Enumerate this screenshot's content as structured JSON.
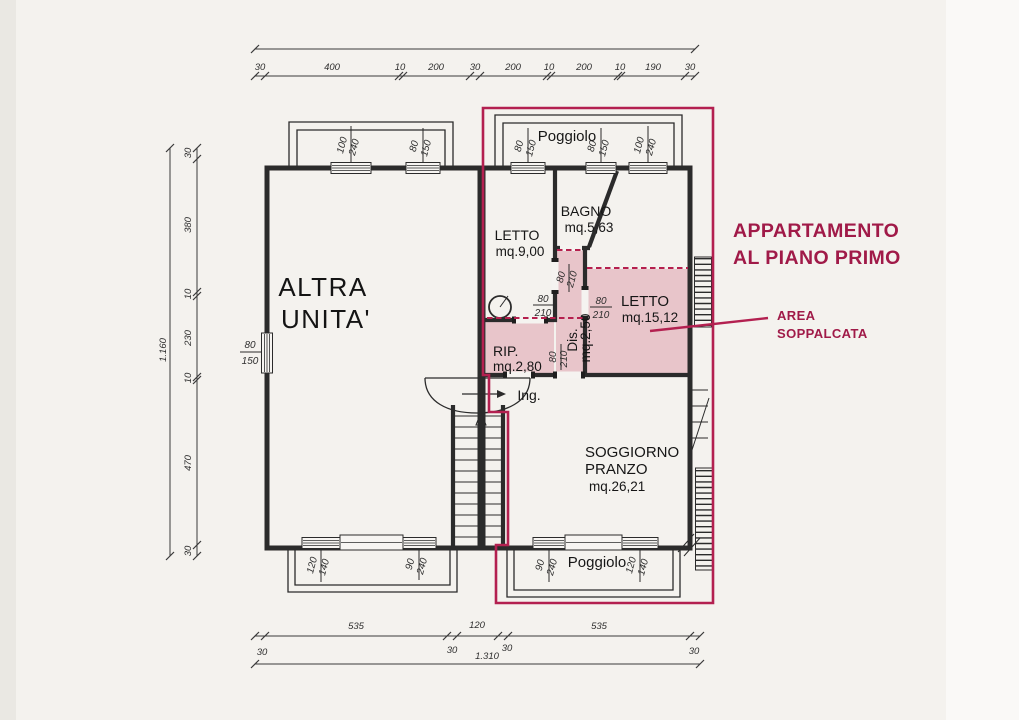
{
  "title": {
    "line1": "APPARTAMENTO",
    "line2": "AL PIANO PRIMO"
  },
  "callout": {
    "line1": "AREA",
    "line2": "SOPPALCATA"
  },
  "colors": {
    "accent": "#a01a48",
    "boundary": "#b32050",
    "soppalco_fill": "#e8c5ca",
    "ink": "#2b2b2b",
    "paper": "#f4f2ee"
  },
  "left_unit": {
    "name_line1": "ALTRA",
    "name_line2": "UNITA'"
  },
  "rooms": {
    "letto1": {
      "name": "LETTO",
      "area": "mq.9,00"
    },
    "bagno": {
      "name": "BAGNO",
      "area": "mq.5,63"
    },
    "letto2": {
      "name": "LETTO",
      "area": "mq.15,12"
    },
    "rip": {
      "name": "RIP.",
      "area": "mq.2,80"
    },
    "dis": {
      "name": "Dis.",
      "area": "mq.2,50"
    },
    "soggiorno": {
      "name_line1": "SOGGIORNO",
      "name_line2": "PRANZO",
      "area": "mq.26,21"
    },
    "ingresso": {
      "name": "Ing."
    },
    "poggiolo_top": {
      "name": "Poggiolo"
    },
    "poggiolo_bottom": {
      "name": "Poggiolo"
    }
  },
  "dims": {
    "top": {
      "segments": [
        "30",
        "400",
        "10",
        "200",
        "30",
        "200",
        "10",
        "200",
        "10",
        "190",
        "30"
      ]
    },
    "left": {
      "total": "1.160",
      "segments": [
        "30",
        "380",
        "10",
        "230",
        "10",
        "470",
        "30"
      ]
    },
    "bottom": {
      "total": "1.310",
      "segments": [
        "535",
        "120",
        "535"
      ],
      "edges": [
        "30",
        "30",
        "30",
        "30"
      ]
    },
    "openings": {
      "tl1": {
        "a": "100",
        "b": "240"
      },
      "tl2": {
        "a": "80",
        "b": "150"
      },
      "lw": {
        "a": "80",
        "b": "150"
      },
      "tr1": {
        "a": "80",
        "b": "150"
      },
      "tr2": {
        "a": "80",
        "b": "150"
      },
      "tr3": {
        "a": "100",
        "b": "240"
      },
      "bl1": {
        "a": "120",
        "b": "140"
      },
      "bl2": {
        "a": "90",
        "b": "240"
      },
      "br1": {
        "a": "90",
        "b": "240"
      },
      "br2": {
        "a": "120",
        "b": "140"
      },
      "d1": {
        "a": "80",
        "b": "210"
      },
      "d2": {
        "a": "80",
        "b": "210"
      },
      "d3": {
        "a": "80",
        "b": "210"
      },
      "d4": {
        "a": "80",
        "b": "210"
      }
    }
  }
}
